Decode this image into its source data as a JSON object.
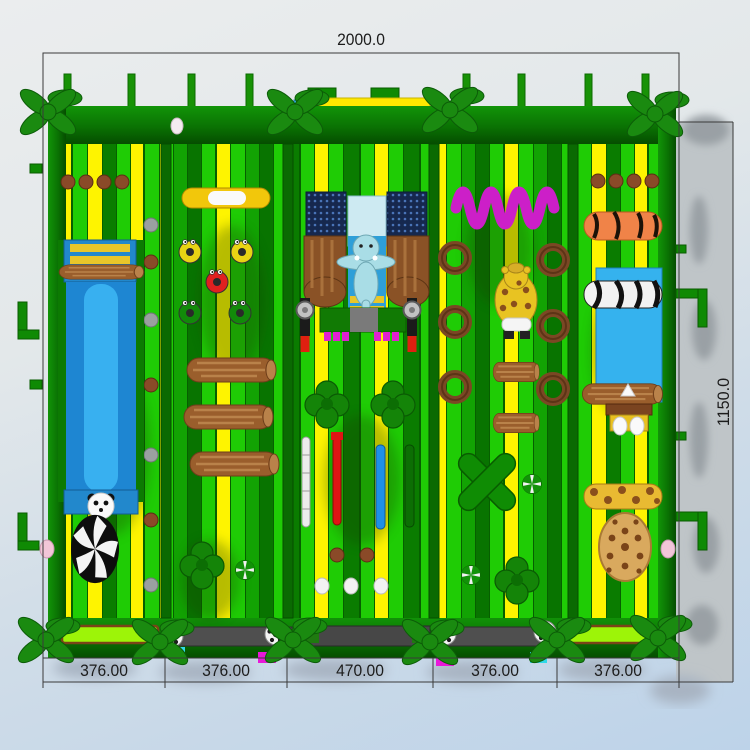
{
  "scene": {
    "name": "inflatable-obstacle-park-plan",
    "view": "top-down 3d render with CAD dimension lines"
  },
  "dimensions": {
    "top_width_label": "2000.0",
    "right_height_label": "1150.0",
    "bottom_segments": [
      "376.00",
      "376.00",
      "470.00",
      "376.00",
      "376.00"
    ]
  },
  "palette": {
    "stripe_green": "#1fcc05",
    "stripe_yellow": "#fef400",
    "stripe_dark_green": "#087400",
    "wall_green": "#0c7a02",
    "palm_green": "#1a8a10",
    "slide_blue": "#38b0f0",
    "pool_blue": "#35b2ee",
    "magenta_accent": "#d024c8",
    "lime_bumper": "#9df408",
    "wood_brown": "#9a5e2c",
    "background_top": "#e9ebec",
    "background_bottom": "#bdd3e9",
    "shadow_gray": "#bfc5c8",
    "dimension_text": "#1c1c1c"
  },
  "elements": [
    "palm-tree",
    "fence-post",
    "slide-lane",
    "panda-face",
    "zebra-swirl-dome",
    "stepping-stones",
    "donut-obstacles",
    "wood-logs",
    "elephant-slide-tower",
    "climbing-mesh",
    "tree-cluster",
    "pole-obstacles",
    "spring-coil",
    "giraffe-figure",
    "brown-rings",
    "green-x-obstacle",
    "pinwheel-candy",
    "tiger-log",
    "zebra-roller",
    "giraffe-log",
    "leopard-dome",
    "chick-egg-station",
    "soccer-ball",
    "lime-bumper",
    "entrance-step"
  ]
}
